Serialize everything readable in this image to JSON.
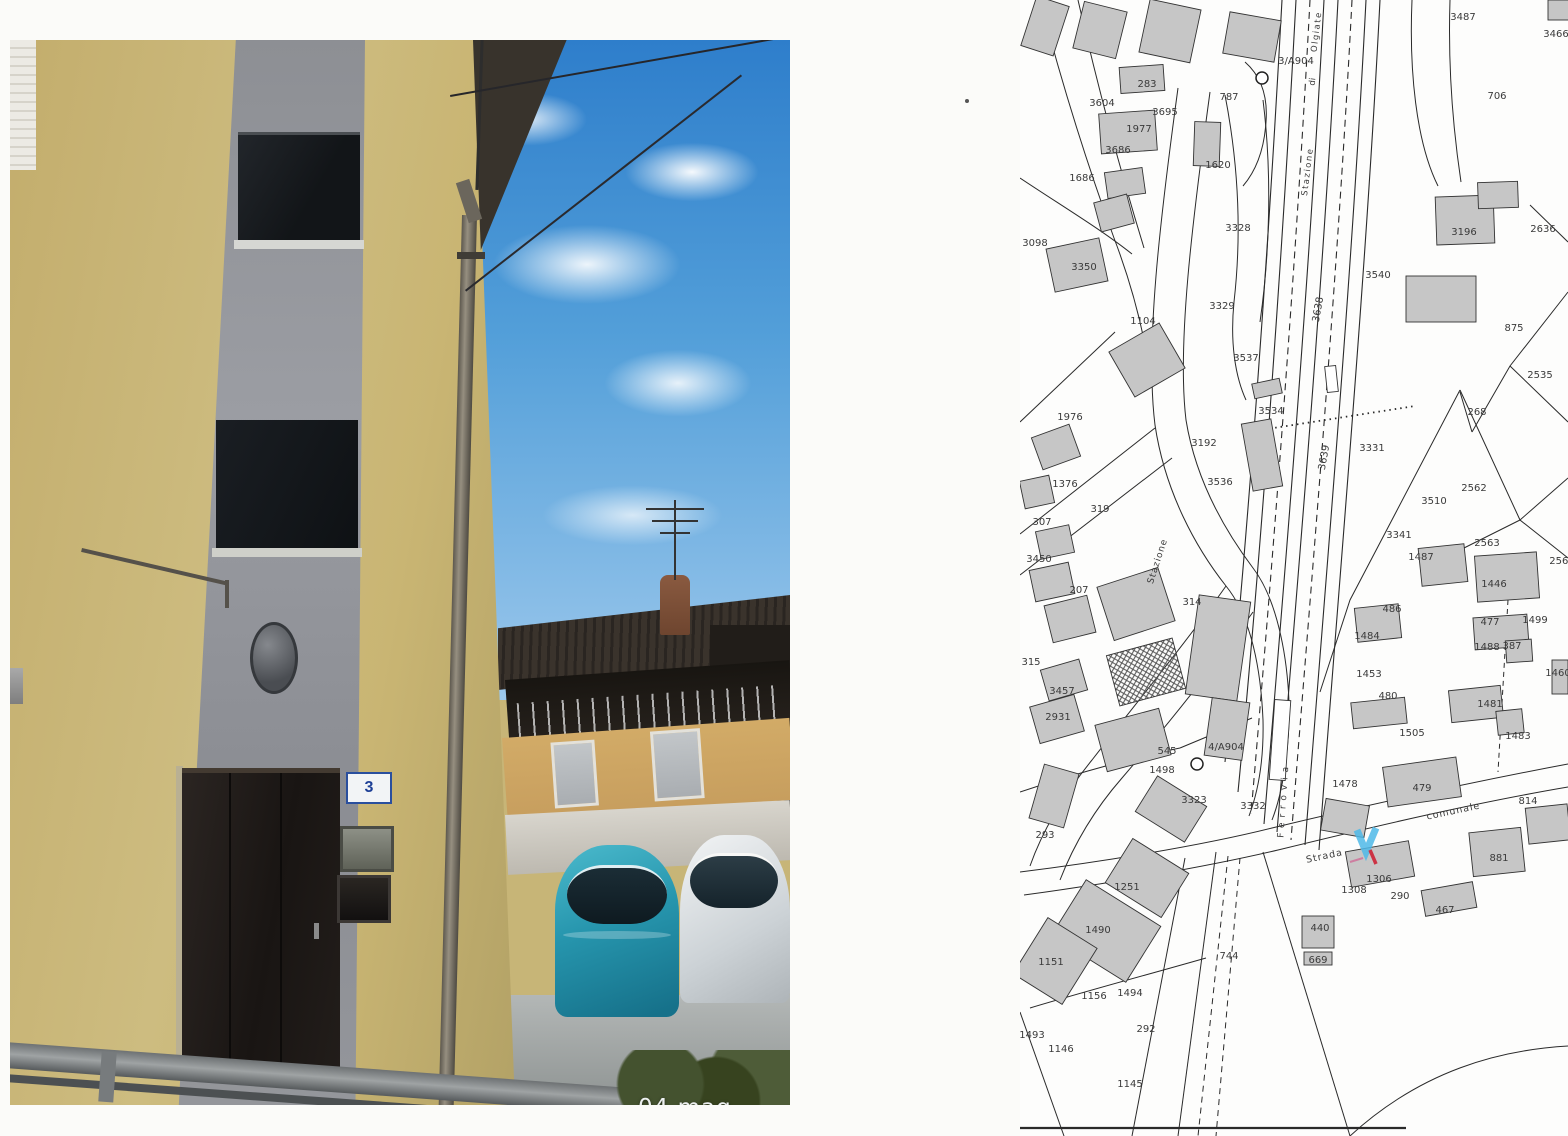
{
  "photo": {
    "date_stamp": "04 mag 2021",
    "door_number": "3"
  },
  "map": {
    "colors": {
      "marker_arrow_blue": "#4db8e8",
      "marker_tick_red": "#cc3344",
      "building_fill": "#c6c6c6"
    },
    "reference_labels": [
      "3/A904",
      "4/A904"
    ],
    "labels": [
      {
        "t": "3487",
        "x": 443,
        "y": 20
      },
      {
        "t": "3466",
        "x": 536,
        "y": 37
      },
      {
        "t": "3/A904",
        "x": 276,
        "y": 64
      },
      {
        "t": "787",
        "x": 209,
        "y": 100
      },
      {
        "t": "283",
        "x": 127,
        "y": 87
      },
      {
        "t": "3604",
        "x": 82,
        "y": 106
      },
      {
        "t": "3695",
        "x": 145,
        "y": 115
      },
      {
        "t": "1977",
        "x": 119,
        "y": 132
      },
      {
        "t": "3686",
        "x": 98,
        "y": 153
      },
      {
        "t": "1686",
        "x": 62,
        "y": 181
      },
      {
        "t": "1620",
        "x": 198,
        "y": 168
      },
      {
        "t": "706",
        "x": 477,
        "y": 99
      },
      {
        "t": "3098",
        "x": 15,
        "y": 246
      },
      {
        "t": "3350",
        "x": 64,
        "y": 270
      },
      {
        "t": "3328",
        "x": 218,
        "y": 231
      },
      {
        "t": "3329",
        "x": 202,
        "y": 309
      },
      {
        "t": "1104",
        "x": 123,
        "y": 324
      },
      {
        "t": "3537",
        "x": 226,
        "y": 361
      },
      {
        "t": "3534",
        "x": 251,
        "y": 414
      },
      {
        "t": "3536",
        "x": 200,
        "y": 485
      },
      {
        "t": "3192",
        "x": 184,
        "y": 446
      },
      {
        "t": "3331",
        "x": 352,
        "y": 451
      },
      {
        "t": "3540",
        "x": 358,
        "y": 278
      },
      {
        "t": "3196",
        "x": 444,
        "y": 235
      },
      {
        "t": "2636",
        "x": 523,
        "y": 232
      },
      {
        "t": "875",
        "x": 494,
        "y": 331
      },
      {
        "t": "2535",
        "x": 520,
        "y": 378
      },
      {
        "t": "268",
        "x": 457,
        "y": 415
      },
      {
        "t": "2562",
        "x": 454,
        "y": 491
      },
      {
        "t": "3510",
        "x": 414,
        "y": 504
      },
      {
        "t": "3341",
        "x": 379,
        "y": 538
      },
      {
        "t": "1487",
        "x": 401,
        "y": 560
      },
      {
        "t": "2563",
        "x": 467,
        "y": 546
      },
      {
        "t": "1446",
        "x": 474,
        "y": 587
      },
      {
        "t": "2561",
        "x": 542,
        "y": 564
      },
      {
        "t": "486",
        "x": 372,
        "y": 612
      },
      {
        "t": "1499",
        "x": 515,
        "y": 623
      },
      {
        "t": "477",
        "x": 470,
        "y": 625
      },
      {
        "t": "1488",
        "x": 467,
        "y": 650
      },
      {
        "t": "387",
        "x": 492,
        "y": 649
      },
      {
        "t": "1460",
        "x": 538,
        "y": 676
      },
      {
        "t": "1484",
        "x": 347,
        "y": 639
      },
      {
        "t": "1453",
        "x": 349,
        "y": 677
      },
      {
        "t": "480",
        "x": 368,
        "y": 699
      },
      {
        "t": "1505",
        "x": 392,
        "y": 736
      },
      {
        "t": "1481",
        "x": 470,
        "y": 707
      },
      {
        "t": "1483",
        "x": 498,
        "y": 739
      },
      {
        "t": "1478",
        "x": 325,
        "y": 787
      },
      {
        "t": "479",
        "x": 402,
        "y": 791
      },
      {
        "t": "814",
        "x": 508,
        "y": 804
      },
      {
        "t": "881",
        "x": 479,
        "y": 861
      },
      {
        "t": "1306",
        "x": 359,
        "y": 882
      },
      {
        "t": "1308",
        "x": 334,
        "y": 893
      },
      {
        "t": "290",
        "x": 380,
        "y": 899
      },
      {
        "t": "467",
        "x": 425,
        "y": 913
      },
      {
        "t": "440",
        "x": 300,
        "y": 931
      },
      {
        "t": "669",
        "x": 298,
        "y": 963
      },
      {
        "t": "744",
        "x": 209,
        "y": 959
      },
      {
        "t": "293",
        "x": 25,
        "y": 838
      },
      {
        "t": "3332",
        "x": 233,
        "y": 809
      },
      {
        "t": "3323",
        "x": 174,
        "y": 803
      },
      {
        "t": "545",
        "x": 147,
        "y": 754
      },
      {
        "t": "4/A904",
        "x": 206,
        "y": 750
      },
      {
        "t": "1498",
        "x": 142,
        "y": 773
      },
      {
        "t": "1251",
        "x": 107,
        "y": 890
      },
      {
        "t": "1490",
        "x": 78,
        "y": 933
      },
      {
        "t": "1151",
        "x": 31,
        "y": 965
      },
      {
        "t": "1156",
        "x": 74,
        "y": 999
      },
      {
        "t": "1494",
        "x": 110,
        "y": 996
      },
      {
        "t": "292",
        "x": 126,
        "y": 1032
      },
      {
        "t": "1493",
        "x": 12,
        "y": 1038
      },
      {
        "t": "1146",
        "x": 41,
        "y": 1052
      },
      {
        "t": "1145",
        "x": 110,
        "y": 1087
      },
      {
        "t": "207",
        "x": 59,
        "y": 593
      },
      {
        "t": "314",
        "x": 172,
        "y": 605
      },
      {
        "t": "315",
        "x": 11,
        "y": 665
      },
      {
        "t": "319",
        "x": 80,
        "y": 512
      },
      {
        "t": "1376",
        "x": 45,
        "y": 487
      },
      {
        "t": "307",
        "x": 22,
        "y": 525
      },
      {
        "t": "3450",
        "x": 19,
        "y": 562
      },
      {
        "t": "3457",
        "x": 42,
        "y": 694
      },
      {
        "t": "2931",
        "x": 38,
        "y": 720
      },
      {
        "t": "1976",
        "x": 50,
        "y": 420
      },
      {
        "t": "3639",
        "x": 307,
        "y": 458,
        "r": -80
      },
      {
        "t": "3638",
        "x": 301,
        "y": 310,
        "r": -80
      },
      {
        "t": "Olgiate",
        "x": 299,
        "y": 32,
        "r": -83,
        "fs": 8.5,
        "ls": 1.5
      },
      {
        "t": "di",
        "x": 295,
        "y": 82,
        "r": -83,
        "fs": 8.5
      },
      {
        "t": "Stazione",
        "x": 290,
        "y": 172,
        "r": -83,
        "fs": 8.5,
        "ls": 1.5
      },
      {
        "t": "Stazione",
        "x": 140,
        "y": 562,
        "r": -72,
        "fs": 9,
        "ls": 1
      },
      {
        "t": "Ferrovia",
        "x": 266,
        "y": 800,
        "r": -86,
        "fs": 9,
        "ls": 5
      },
      {
        "t": "Strada",
        "x": 305,
        "y": 859,
        "r": -12,
        "fs": 9.5,
        "ls": 1
      },
      {
        "t": "comunale",
        "x": 434,
        "y": 814,
        "r": -12,
        "fs": 9.5,
        "ls": 1
      }
    ]
  }
}
